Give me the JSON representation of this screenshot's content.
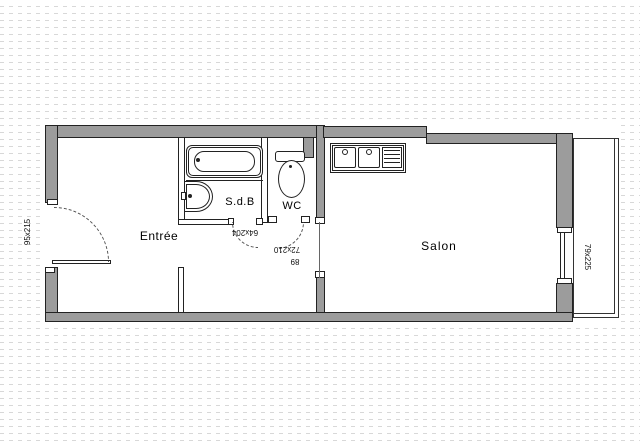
{
  "document": {
    "type": "apartment-floor-plan"
  },
  "rooms": {
    "entree": {
      "label": "Entrée"
    },
    "sdb": {
      "label": "S.d.B"
    },
    "wc": {
      "label": "WC"
    },
    "salon": {
      "label": "Salon"
    }
  },
  "dimensions": {
    "entry_door": "95x215",
    "sdb_door": "64x204",
    "wc_door": "72x210",
    "passage": "89",
    "window": "79x225"
  },
  "fixtures": {
    "bathtub": "bathtub-icon",
    "washbasin": "washbasin-icon",
    "toilet": "toilet-icon",
    "kitchen_sink": "kitchen-sink-icon"
  },
  "colors": {
    "wall_fill": "#9c9c9c",
    "outline": "#222222",
    "grid_dash": "#d8d8d8",
    "background": "#ffffff"
  }
}
